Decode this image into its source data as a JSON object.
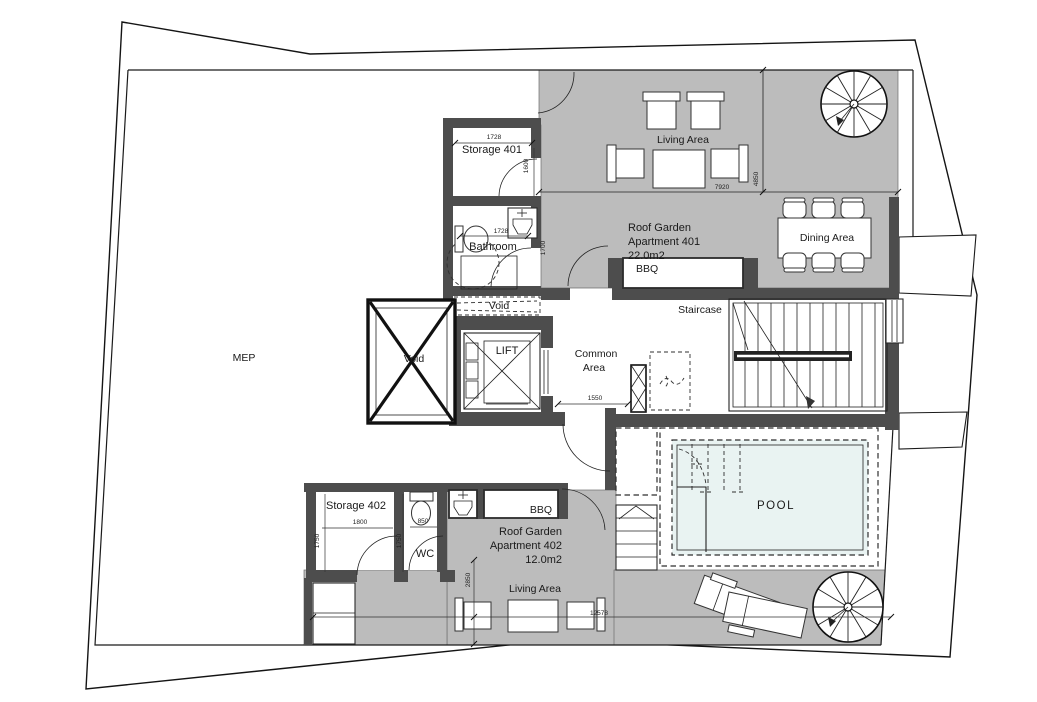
{
  "labels": {
    "mep": "MEP",
    "storage401": "Storage 401",
    "bathroom": "Bathroom",
    "void_shaft": "Void",
    "void_slab": "Void",
    "lift": "LIFT",
    "common_line1": "Common",
    "common_line2": "Area",
    "staircase": "Staircase",
    "living_area_401": "Living Area",
    "dining_area": "Dining Area",
    "apt401_line1": "Roof Garden",
    "apt401_line2": "Apartment 401",
    "apt401_line3": "22.0m2",
    "bbq401": "BBQ",
    "pool": "POOL",
    "storage402": "Storage 402",
    "wc": "WC",
    "bbq402": "BBQ",
    "apt402_line1": "Roof Garden",
    "apt402_line2": "Apartment 402",
    "apt402_line3": "12.0m2",
    "living_area_402": "Living Area"
  },
  "dimensions": {
    "storage401_width": "1728",
    "storage401_depth": "1600",
    "bathroom_width": "1728",
    "bathroom_depth": "1700",
    "common_width": "1550",
    "terrace401_width": "7920",
    "terrace401_depth": "4850",
    "storage402_width": "1800",
    "storage402_depth": "1750",
    "wc_width": "850",
    "wc_depth": "1750",
    "terrace402_depth": "2850",
    "terrace402_width": "12578"
  },
  "colors": {
    "terrace_grey": "#bcbcbc",
    "wall_dark": "#4d4d4d",
    "pool_water": "#e9f3f2",
    "line": "#1a1a1a"
  }
}
